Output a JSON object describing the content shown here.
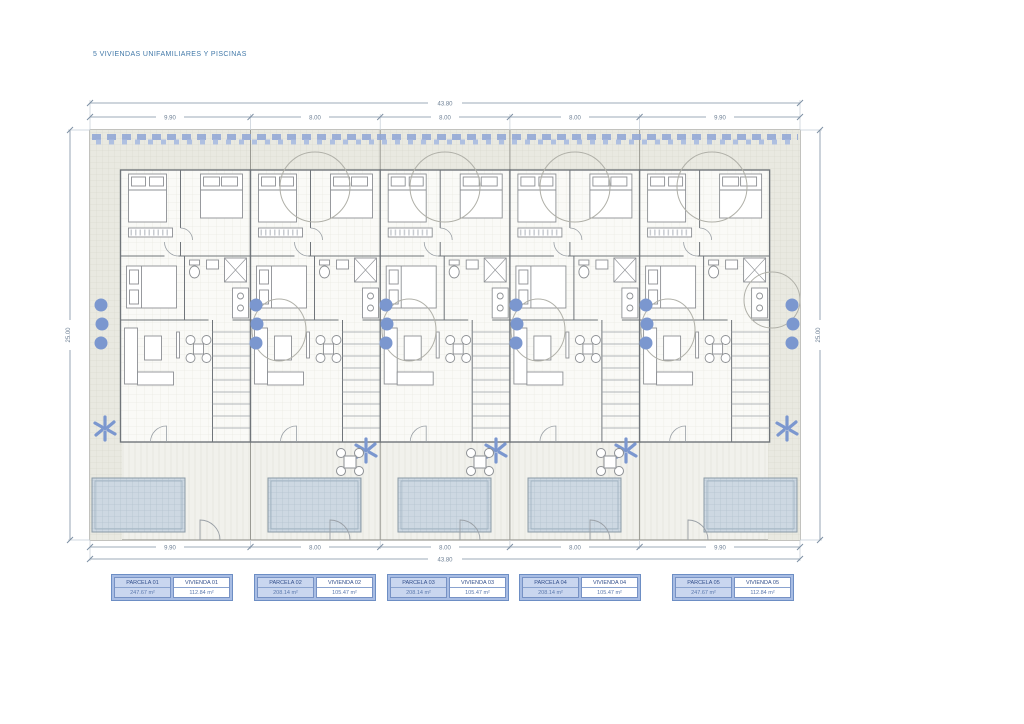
{
  "title": "5 VIVIENDAS UNIFAMILIARES Y PISCINAS",
  "dimensions": {
    "top_total": "43.80",
    "bottom_total": "43.80",
    "top_segments": [
      "9.90",
      "8.00",
      "8.00",
      "8.00",
      "9.90"
    ],
    "bottom_segments": [
      "9.90",
      "8.00",
      "8.00",
      "8.00",
      "9.90"
    ],
    "left_side": "25.00",
    "right_side": "25.00"
  },
  "legend": [
    {
      "parcel_label": "PARCELA 01",
      "parcel_area": "247.67 m²",
      "dwelling_label": "VIVIENDA 01",
      "dwelling_area": "112.84 m²"
    },
    {
      "parcel_label": "PARCELA 02",
      "parcel_area": "208.14 m²",
      "dwelling_label": "VIVIENDA 02",
      "dwelling_area": "105.47 m²"
    },
    {
      "parcel_label": "PARCELA 03",
      "parcel_area": "208.14 m²",
      "dwelling_label": "VIVIENDA 03",
      "dwelling_area": "105.47 m²"
    },
    {
      "parcel_label": "PARCELA 04",
      "parcel_area": "208.14 m²",
      "dwelling_label": "VIVIENDA 04",
      "dwelling_area": "105.47 m²"
    },
    {
      "parcel_label": "PARCELA 05",
      "parcel_area": "247.67 m²",
      "dwelling_label": "VIVIENDA 05",
      "dwelling_area": "112.84 m²"
    }
  ],
  "colors": {
    "accent_blue": "#4178a8",
    "plant_blue": "#7b97cf",
    "hedge_blue": "#8fa6d6",
    "pool_fill": "#cdd8e2",
    "legend_fill": "#a8bde4",
    "wall_gray": "#70757a"
  }
}
